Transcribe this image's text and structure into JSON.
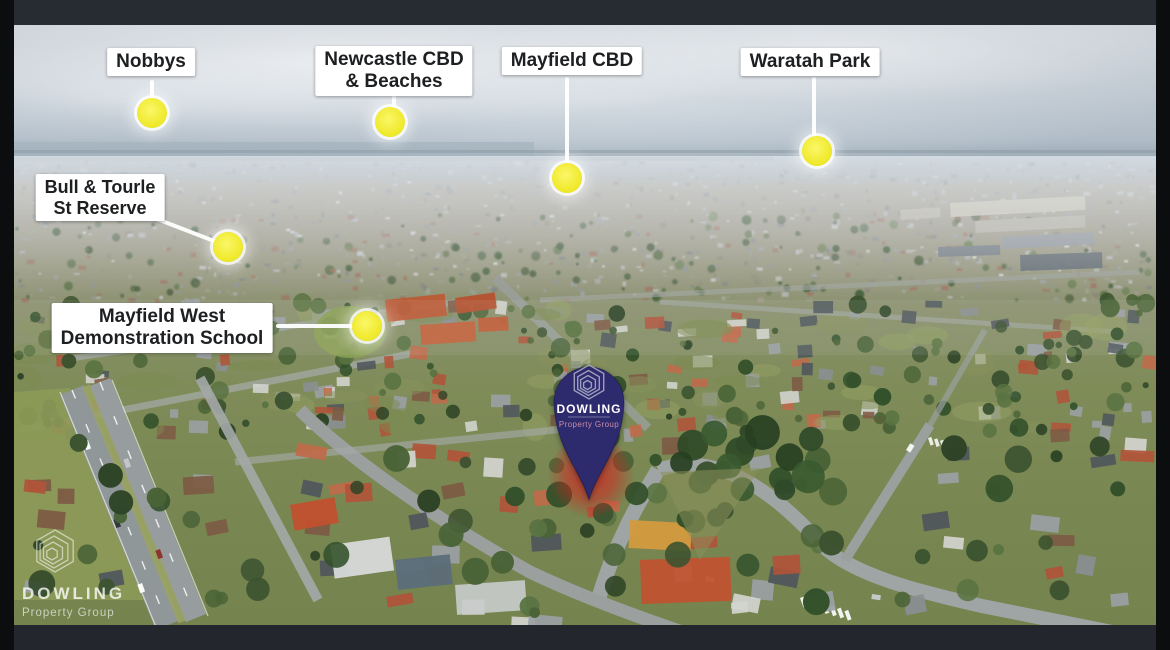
{
  "colors": {
    "marker_dot": "#f0ea30",
    "label_bg": "#ffffff",
    "label_text": "#1d1f21",
    "pin_fill": "#2d2a6e",
    "pin_brand_text": "#ffffff",
    "pin_sub_text": "#c98da6",
    "highlight_red": "#d62220",
    "frame_top": "#272b32",
    "frame_bottom": "#23272d",
    "frame_side": "#0c0d0f"
  },
  "markers": [
    {
      "id": "nobbys",
      "lines": [
        "Nobbys"
      ]
    },
    {
      "id": "newcastle-cbd-beaches",
      "lines": [
        "Newcastle CBD",
        "& Beaches"
      ]
    },
    {
      "id": "mayfield-cbd",
      "lines": [
        "Mayfield CBD"
      ]
    },
    {
      "id": "waratah-park",
      "lines": [
        "Waratah Park"
      ]
    },
    {
      "id": "bull-tourle-st-reserve",
      "lines": [
        "Bull & Tourle",
        "St Reserve"
      ]
    },
    {
      "id": "mayfield-west-demonstration-school",
      "lines": [
        "Mayfield West",
        "Demonstration School"
      ]
    }
  ],
  "property_pin": {
    "brand": "DOWLING",
    "subtitle": "Property Group"
  },
  "watermark": {
    "brand": "DOWLING",
    "subtitle": "Property Group"
  }
}
